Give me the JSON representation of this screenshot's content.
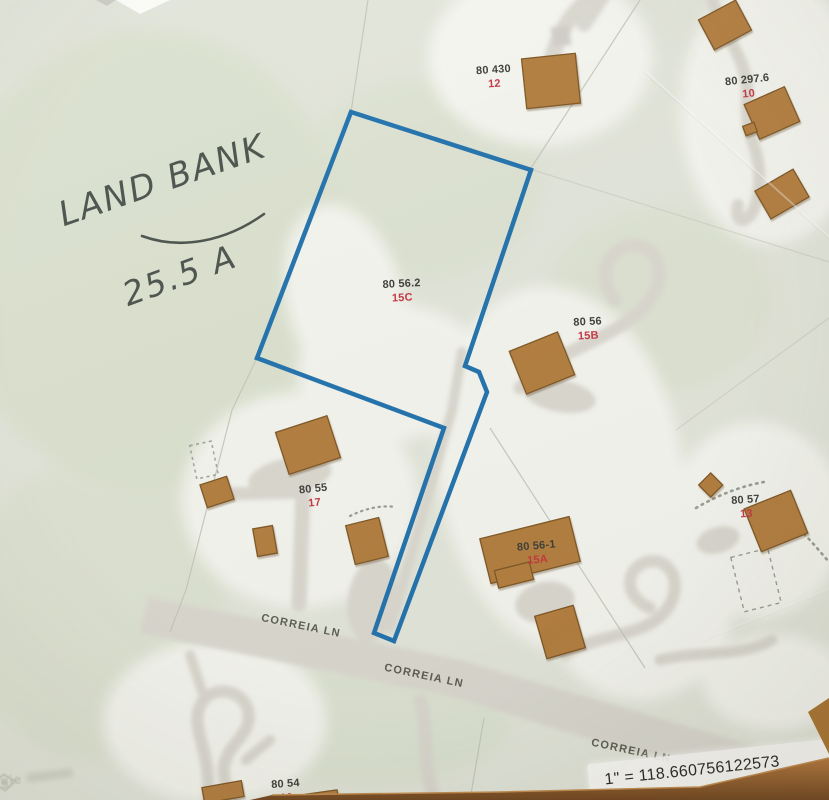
{
  "annotation": {
    "line1": "LAND BANK",
    "line2": "25.5 A"
  },
  "parcels": [
    {
      "id": "80 430",
      "lot": "12"
    },
    {
      "id": "80 297.6",
      "lot": "10"
    },
    {
      "id": "80 56.2",
      "lot": "15C"
    },
    {
      "id": "80 56",
      "lot": "15B"
    },
    {
      "id": "80 55",
      "lot": "17"
    },
    {
      "id": "80 56-1",
      "lot": "15A"
    },
    {
      "id": "80 57",
      "lot": "13"
    },
    {
      "id": "80 54",
      "lot": "16"
    }
  ],
  "road_labels": [
    "CORREIA LN",
    "CORREIA LN",
    "CORREIA LN"
  ],
  "scale_text": "1\" = 118.660756122573",
  "watermark": {
    "partial_text": "agie",
    "icon": "diamond-logo"
  },
  "colors": {
    "paper": "#e2e5da",
    "lawn": "#f4f5ef",
    "green_tint": "#dbe1cf",
    "pavement": "#d9d7cf",
    "building_fill": "#b27c3c",
    "building_edge": "#7d5423",
    "parcel_outline_blue": "#1f71ad",
    "label_text": "#3c3c38",
    "lot_text": "#c43440",
    "handwriting": "#49514b",
    "table_wood": "#a9712f"
  }
}
